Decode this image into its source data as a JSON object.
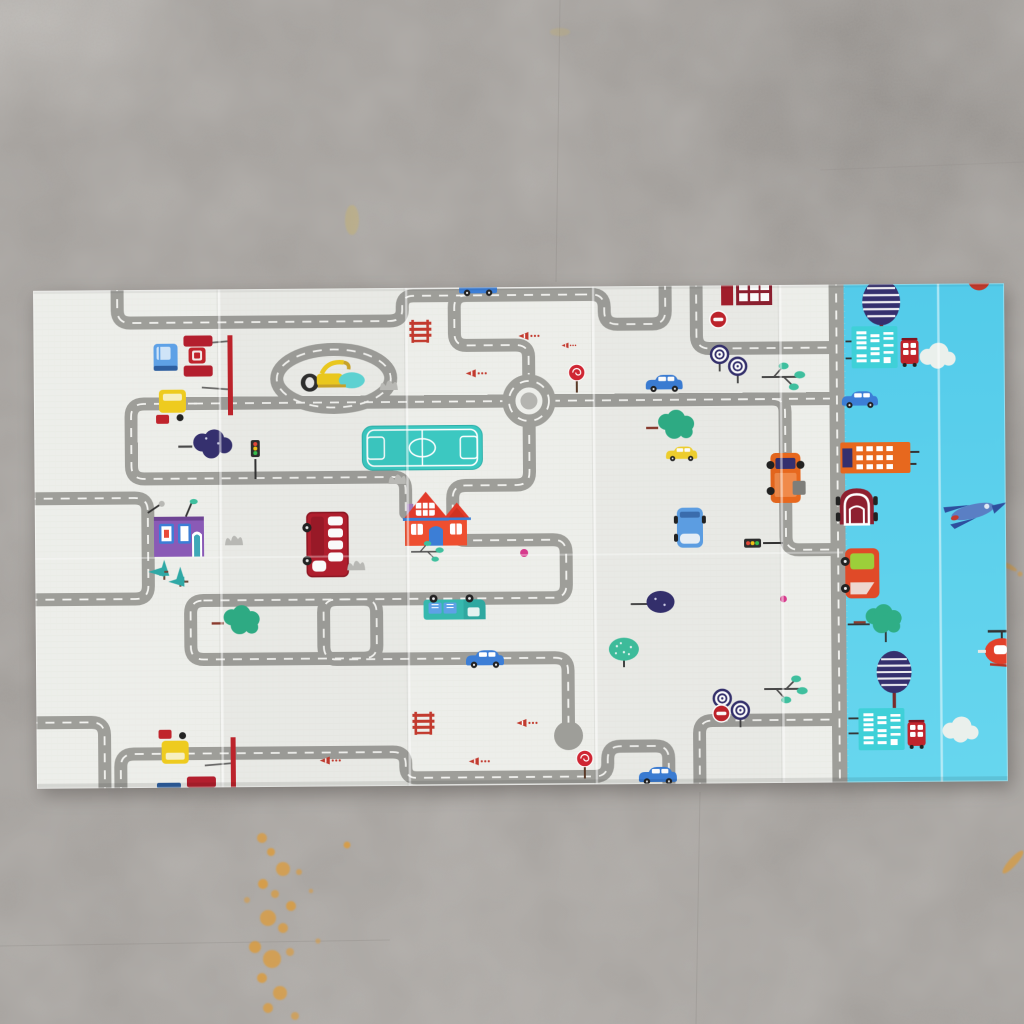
{
  "scene": {
    "description": "Top-down photo of a foldable baby play mat lying on a gray concrete floor",
    "floor": {
      "material": "speckled concrete",
      "marks": [
        {
          "name": "orange-paint-splatter-trail",
          "area": "bottom-left",
          "color_key": "stain"
        },
        {
          "name": "orange-streak",
          "area": "right-of-mat",
          "color_key": "stain"
        },
        {
          "name": "yellow-smudge",
          "area": "upper-left",
          "color_key": "stain"
        },
        {
          "name": "light-worn-patches",
          "color_key": "concrete"
        }
      ]
    },
    "mat": {
      "type": "foldable XPE play mat, slightly rotated",
      "fold_creases": {
        "vertical": 5,
        "horizontal": 1
      },
      "panels": [
        {
          "id": "road-map-panel",
          "background_key": "mat_white",
          "theme": "winding gray roads maze with dashed centerlines, mirrored top/bottom print",
          "objects": [
            {
              "name": "red-double-decker-bus",
              "color_key": "bus_red"
            },
            {
              "name": "red-gabled-house",
              "color_key": "house_red"
            },
            {
              "name": "purple-house",
              "color_key": "purple"
            },
            {
              "name": "teal-sports-field",
              "color_key": "teal"
            },
            {
              "name": "roundabout",
              "color_key": "road"
            },
            {
              "name": "cul-de-sac-bulb",
              "color_key": "road"
            },
            {
              "name": "excavator",
              "count": 3,
              "color_key": "yellow"
            },
            {
              "name": "fire-station-truck-cluster",
              "count": 2,
              "color_key": "red"
            },
            {
              "name": "blue-sedan",
              "count": 4,
              "color_key": "blue"
            },
            {
              "name": "yellow-taxi",
              "color_key": "taxi"
            },
            {
              "name": "blue-van",
              "color_key": "light_blue"
            },
            {
              "name": "teal-pickup-truck",
              "color_key": "teal"
            },
            {
              "name": "orange-box-truck",
              "color_key": "orange"
            },
            {
              "name": "traffic-light",
              "count": 2
            },
            {
              "name": "no-entry-sign",
              "count": 2,
              "color_key": "red"
            },
            {
              "name": "red-lollipop-sign",
              "count": 2,
              "color_key": "red"
            },
            {
              "name": "striped-barrier",
              "count": 2,
              "color_key": "red"
            },
            {
              "name": "traffic-cone",
              "count": 5,
              "color_key": "red"
            },
            {
              "name": "swirl-lollipop-tree",
              "count": 4,
              "color_key": "navy"
            },
            {
              "name": "navy-round-tree",
              "count": 2,
              "color_key": "navy"
            },
            {
              "name": "green-cloud-tree",
              "count": 3,
              "color_key": "teal_green"
            },
            {
              "name": "teal-dotted-tree",
              "color_key": "teal_green"
            },
            {
              "name": "teal-branch-tree",
              "count": 3,
              "color_key": "teal_green"
            },
            {
              "name": "teal-pine-tree",
              "count": 2,
              "color_key": "teal_green"
            },
            {
              "name": "gray-bush",
              "count": 4,
              "color_key": "bush"
            },
            {
              "name": "pink-dot",
              "count": 2,
              "color_key": "magenta"
            },
            {
              "name": "red-window-building",
              "color_key": "deep_red"
            }
          ]
        },
        {
          "id": "sky-blue-panel",
          "background_key": "sky",
          "theme": "sky-blue strip with buildings, trees, vehicles and clouds along a vertical road",
          "objects": [
            {
              "name": "striped-navy-tree",
              "count": 2,
              "color_key": "navy"
            },
            {
              "name": "teal-window-building",
              "count": 2,
              "color_key": "teal"
            },
            {
              "name": "red-mini-bus",
              "count": 2,
              "color_key": "red"
            },
            {
              "name": "white-cloud",
              "count": 2,
              "color_key": "cloud"
            },
            {
              "name": "blue-sedan",
              "color_key": "blue"
            },
            {
              "name": "orange-highrise",
              "color_key": "orange"
            },
            {
              "name": "dark-red-beetle-car",
              "color_key": "deep_red"
            },
            {
              "name": "fighter-jet",
              "color_key": "blue"
            },
            {
              "name": "red-truck-green-windshield",
              "color_key": "red"
            },
            {
              "name": "green-round-tree",
              "color_key": "teal_green"
            },
            {
              "name": "red-helicopter",
              "color_key": "heli_red"
            },
            {
              "name": "partial-red-car-top-corner",
              "color_key": "red"
            }
          ]
        }
      ]
    }
  },
  "palette": {
    "mat_white": "#edeeea",
    "road": "#9e9e99",
    "road_dash": "#f4f4f1",
    "sky": "#53cbea",
    "sky_deep": "#45c2e6",
    "cloud": "#eaf0ec",
    "concrete": "#a19d99",
    "stain": "#df9a33",
    "red": "#c23a2e",
    "deep_red": "#8e2030",
    "bus_red": "#b31f2e",
    "house_red": "#ee4f30",
    "roof_red": "#e23b2a",
    "blue": "#3c7ed6",
    "light_blue": "#5ea1e6",
    "navy": "#35306e",
    "teal": "#3cc8c1",
    "teal_green": "#3fbf9e",
    "green": "#2fae86",
    "yellow": "#eecb1f",
    "orange": "#e7681e",
    "taxi": "#f2d22e",
    "purple": "#8a5ab6",
    "magenta": "#d63a8c",
    "bush": "#bcbcb8",
    "dark": "#333333",
    "wheel": "#222222",
    "lime": "#9ccf3a",
    "heli_red": "#e2402a",
    "white": "#ffffff"
  }
}
